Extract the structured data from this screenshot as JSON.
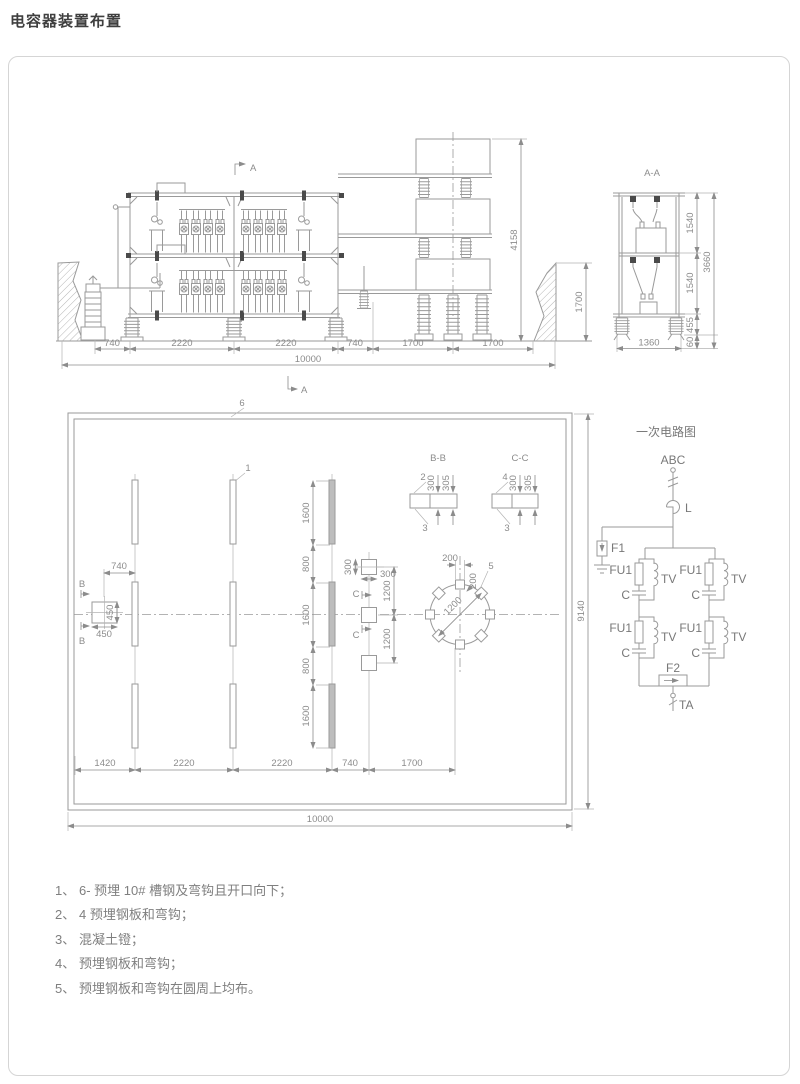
{
  "page_title": "电容器装置布置",
  "elevation": {
    "marker_a": "A",
    "chain": [
      "740",
      "2220",
      "2220",
      "740",
      "1700",
      "1700"
    ],
    "total": "10000",
    "reactor_height": "4158",
    "wall_height": "1700"
  },
  "section_aa": {
    "title": "A-A",
    "d1540a": "1540",
    "d1540b": "1540",
    "d3660": "3660",
    "d455": "455",
    "d60": "60",
    "d1360": "1360"
  },
  "plan": {
    "marker_a": "A",
    "label_6": "6",
    "label_1": "1",
    "label_5": "5",
    "marker_b": "B",
    "marker_c": "C",
    "d740": "740",
    "d450v": "450",
    "d450h": "450",
    "row_chain": [
      "1600",
      "800",
      "1600",
      "800",
      "1600"
    ],
    "bottom_chain": [
      "1420",
      "2220",
      "2220",
      "740",
      "1700"
    ],
    "total_w": "10000",
    "total_h": "9140",
    "d300v": "300",
    "d300h": "300",
    "d1200a": "1200",
    "d1200b": "1200",
    "d200a": "200",
    "d200b": "200",
    "d1200dia": "1200"
  },
  "detail_bb": {
    "title": "B-B",
    "l_top": "2",
    "l_bottom": "3",
    "d300": "300",
    "d305": "305"
  },
  "detail_cc": {
    "title": "C-C",
    "l_top": "4",
    "l_bottom": "3",
    "d300": "300",
    "d305": "305"
  },
  "circuit": {
    "title": "一次电路图",
    "abc": "ABC",
    "l": "L",
    "f1": "F1",
    "fu1": "FU1",
    "tv": "TV",
    "c": "C",
    "f2": "F2",
    "ta": "TA"
  },
  "notes": [
    {
      "num": "1、",
      "text": "6- 预埋 10# 槽钢及弯钩且开口向下；"
    },
    {
      "num": "2、",
      "text": "4 预埋钢板和弯钩；"
    },
    {
      "num": "3、",
      "text": "混凝土镫；"
    },
    {
      "num": "4、",
      "text": "预埋钢板和弯钩；"
    },
    {
      "num": "5、",
      "text": "预埋钢板和弯钩在圆周上均布。"
    }
  ],
  "colors": {
    "line": "#9a9a9a",
    "dim_text": "#8c8c8c",
    "panel_border": "#d5d5d5",
    "title_text": "#3f3f3f",
    "note_text": "#7f7f7f",
    "clamp": "#4a4a4a",
    "strip_fill": "#bdbdbd"
  }
}
